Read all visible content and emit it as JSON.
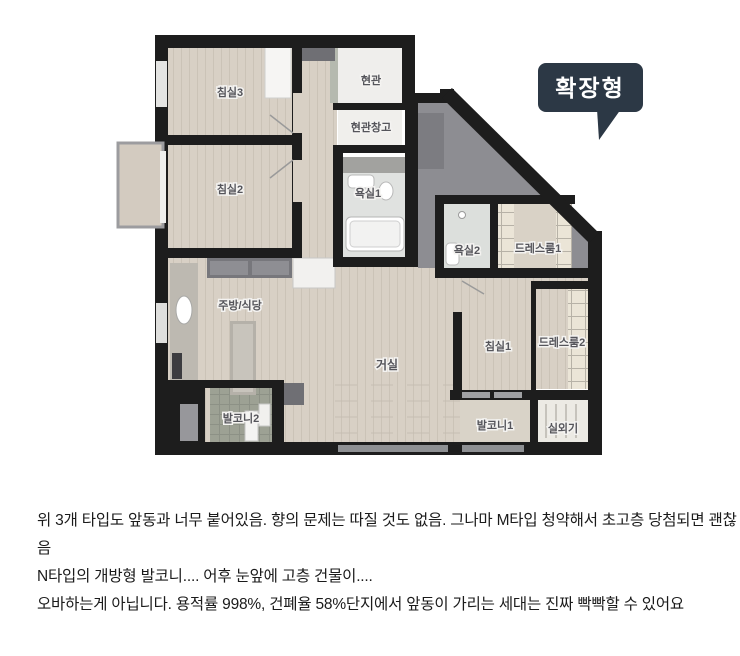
{
  "floorplan": {
    "badge": {
      "label": "확장형",
      "bg": "#2c3845",
      "text_color": "#ffffff"
    },
    "rooms": {
      "bedroom3": {
        "label": "침실3"
      },
      "bedroom2": {
        "label": "침실2"
      },
      "entrance": {
        "label": "현관"
      },
      "entrance_storage": {
        "label": "현관창고"
      },
      "bathroom1": {
        "label": "욕실1"
      },
      "bathroom2": {
        "label": "욕실2"
      },
      "dressroom1": {
        "label": "드레스룸1"
      },
      "kitchen_dining": {
        "label": "주방/식당"
      },
      "living_room": {
        "label": "거실"
      },
      "bedroom1": {
        "label": "침실1"
      },
      "dressroom2": {
        "label": "드레스룸2"
      },
      "balcony2": {
        "label": "발코니2"
      },
      "balcony1": {
        "label": "발코니1"
      },
      "outdoor_unit": {
        "label": "실외기"
      }
    },
    "colors": {
      "wall": "#1d1d1d",
      "wood_floor": "#d8d0c5",
      "unexpanded_gray": "#8d8d92",
      "badge_bg": "#2c3845"
    }
  },
  "comment": {
    "lines": [
      "위 3개 타입도 앞동과 너무 붙어있음. 향의 문제는 따질 것도 없음. 그나마 M타입 청약해서 초고층 당첨되면 괜찮",
      "음",
      "N타입의 개방형 발코니.... 어후 눈앞에 고층 건물이....",
      "오바하는게 아닙니다. 용적률 998%, 건폐율 58%단지에서 앞동이 가리는 세대는 진짜 빡빡할 수 있어요"
    ]
  }
}
